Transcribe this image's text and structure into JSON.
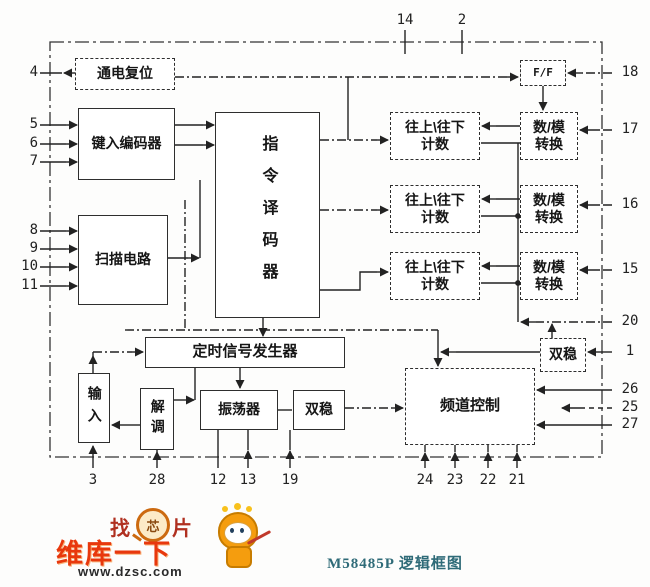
{
  "title": "M58485P 逻辑框图",
  "blocks": {
    "power_on_reset": "通电复位",
    "key_encoder": "键入编码器",
    "scan_circuit": "扫描电路",
    "instruction_decoder": "指令译码器",
    "flip_flop": "F/F",
    "counter_top": "往上\\往下",
    "counter_bottom": "计数",
    "dac_top": "数/模",
    "dac_bottom": "转换",
    "timing_generator": "定时信号发生器",
    "input": "输入",
    "demodulator": "解调",
    "oscillator": "振荡器",
    "bistable": "双稳",
    "channel_control": "频道控制"
  },
  "pins": {
    "left": [
      "4",
      "5",
      "6",
      "7",
      "8",
      "9",
      "10",
      "11"
    ],
    "right": [
      "18",
      "17",
      "16",
      "15",
      "20",
      "1",
      "26",
      "25",
      "27"
    ],
    "top": [
      "14",
      "2"
    ],
    "bottom": [
      "3",
      "28",
      "12",
      "13",
      "19",
      "24",
      "23",
      "22",
      "21"
    ]
  },
  "watermark": {
    "zhao": "找",
    "xin": "芯",
    "pian": "片",
    "brand": "维库一下",
    "url": "www.dzsc.com"
  },
  "colors": {
    "line": "#222222",
    "caption": "#2f6b78",
    "brand_red": "#e8380d",
    "mascot_orange": "#f59d0e"
  }
}
